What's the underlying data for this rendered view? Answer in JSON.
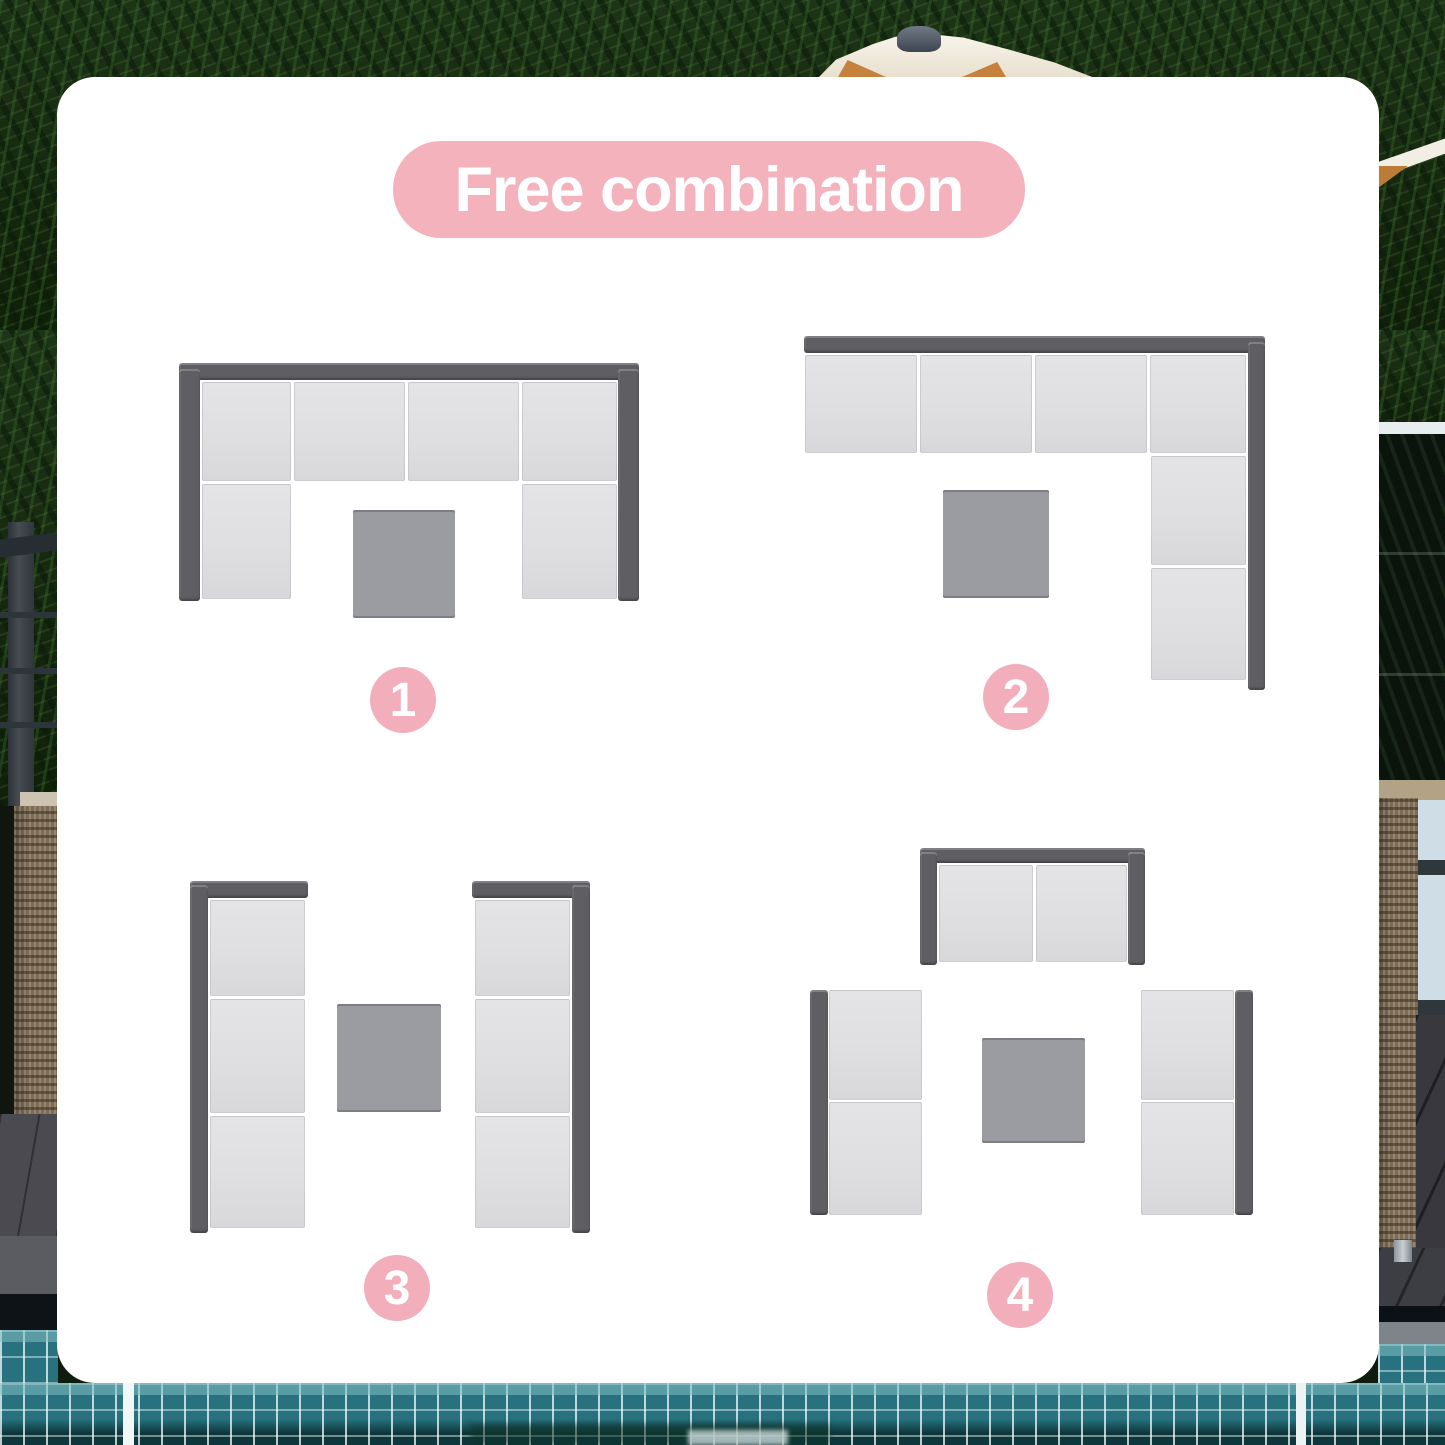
{
  "card": {
    "title": "Free combination"
  },
  "theme": {
    "pink_banner": "#f4b3bc",
    "pink_badge": "#f3aebb",
    "seat_gray": "#dfdfe1",
    "backrest_gray": "#5e5e63",
    "table_gray": "#9b9ba2",
    "card_white": "#ffffff",
    "pool_teal": "#27727e",
    "foliage_green": "#1d3416"
  },
  "diagrams": [
    {
      "label": "1",
      "name": "u-shape-sectional-with-table",
      "pieces": [
        {
          "t": "back",
          "x": 0,
          "y": 0,
          "w": 460,
          "h": 17
        },
        {
          "t": "back",
          "x": 0,
          "y": 6,
          "w": 21,
          "h": 232
        },
        {
          "t": "back",
          "x": 439,
          "y": 6,
          "w": 21,
          "h": 232
        },
        {
          "t": "seat",
          "x": 23,
          "y": 19,
          "w": 89,
          "h": 99
        },
        {
          "t": "seat",
          "x": 115,
          "y": 19,
          "w": 111,
          "h": 99
        },
        {
          "t": "seat",
          "x": 229,
          "y": 19,
          "w": 111,
          "h": 99
        },
        {
          "t": "seat",
          "x": 343,
          "y": 19,
          "w": 95,
          "h": 99
        },
        {
          "t": "seat",
          "x": 23,
          "y": 121,
          "w": 89,
          "h": 115
        },
        {
          "t": "seat",
          "x": 343,
          "y": 121,
          "w": 95,
          "h": 115
        },
        {
          "t": "table",
          "x": 174,
          "y": 147,
          "w": 102,
          "h": 108
        }
      ]
    },
    {
      "label": "2",
      "name": "l-shape-sectional-with-table",
      "pieces": [
        {
          "t": "back",
          "x": 0,
          "y": 0,
          "w": 461,
          "h": 17
        },
        {
          "t": "back",
          "x": 444,
          "y": 6,
          "w": 17,
          "h": 348
        },
        {
          "t": "seat",
          "x": 1,
          "y": 19,
          "w": 112,
          "h": 98
        },
        {
          "t": "seat",
          "x": 116,
          "y": 19,
          "w": 112,
          "h": 98
        },
        {
          "t": "seat",
          "x": 231,
          "y": 19,
          "w": 112,
          "h": 98
        },
        {
          "t": "seat",
          "x": 346,
          "y": 19,
          "w": 96,
          "h": 98
        },
        {
          "t": "seat",
          "x": 347,
          "y": 120,
          "w": 95,
          "h": 109
        },
        {
          "t": "seat",
          "x": 347,
          "y": 232,
          "w": 95,
          "h": 112
        },
        {
          "t": "table",
          "x": 139,
          "y": 154,
          "w": 106,
          "h": 108
        }
      ]
    },
    {
      "label": "3",
      "name": "two-facing-sofas-with-table",
      "pieces": [
        {
          "t": "back",
          "x": 0,
          "y": 0,
          "w": 118,
          "h": 17
        },
        {
          "t": "back",
          "x": 0,
          "y": 4,
          "w": 18,
          "h": 348
        },
        {
          "t": "back",
          "x": 282,
          "y": 0,
          "w": 118,
          "h": 17
        },
        {
          "t": "back",
          "x": 382,
          "y": 4,
          "w": 18,
          "h": 348
        },
        {
          "t": "seat",
          "x": 20,
          "y": 19,
          "w": 95,
          "h": 96
        },
        {
          "t": "seat",
          "x": 20,
          "y": 118,
          "w": 95,
          "h": 114
        },
        {
          "t": "seat",
          "x": 20,
          "y": 235,
          "w": 95,
          "h": 112
        },
        {
          "t": "seat",
          "x": 285,
          "y": 19,
          "w": 95,
          "h": 96
        },
        {
          "t": "seat",
          "x": 285,
          "y": 118,
          "w": 95,
          "h": 114
        },
        {
          "t": "seat",
          "x": 285,
          "y": 235,
          "w": 95,
          "h": 112
        },
        {
          "t": "table",
          "x": 147,
          "y": 123,
          "w": 104,
          "h": 108
        }
      ]
    },
    {
      "label": "4",
      "name": "loveseat-with-two-facing-sofas-and-table",
      "pieces": [
        {
          "t": "back",
          "x": 110,
          "y": 0,
          "w": 225,
          "h": 15
        },
        {
          "t": "back",
          "x": 110,
          "y": 4,
          "w": 17,
          "h": 113
        },
        {
          "t": "back",
          "x": 318,
          "y": 4,
          "w": 17,
          "h": 113
        },
        {
          "t": "seat",
          "x": 129,
          "y": 17,
          "w": 94,
          "h": 97
        },
        {
          "t": "seat",
          "x": 226,
          "y": 17,
          "w": 91,
          "h": 97
        },
        {
          "t": "back",
          "x": 0,
          "y": 142,
          "w": 18,
          "h": 225
        },
        {
          "t": "seat",
          "x": 19,
          "y": 142,
          "w": 93,
          "h": 110
        },
        {
          "t": "seat",
          "x": 19,
          "y": 254,
          "w": 93,
          "h": 113
        },
        {
          "t": "seat",
          "x": 331,
          "y": 142,
          "w": 93,
          "h": 110
        },
        {
          "t": "seat",
          "x": 331,
          "y": 254,
          "w": 93,
          "h": 113
        },
        {
          "t": "back",
          "x": 425,
          "y": 142,
          "w": 18,
          "h": 225
        },
        {
          "t": "table",
          "x": 172,
          "y": 190,
          "w": 103,
          "h": 105
        }
      ]
    }
  ]
}
